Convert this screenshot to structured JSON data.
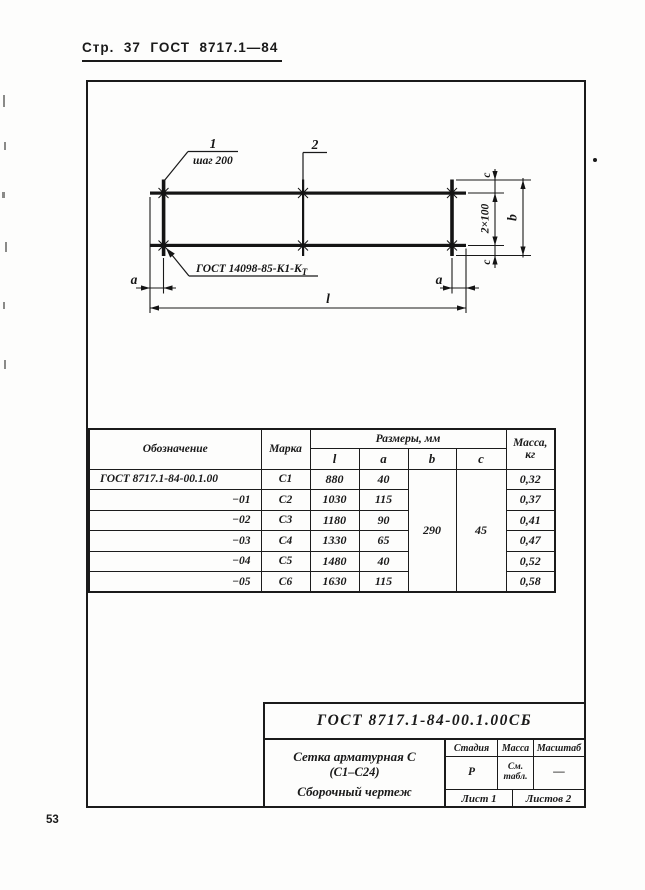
{
  "page": {
    "header": "Стр.  37  ГОСТ  8717.1—84",
    "page_number": "53"
  },
  "drawing": {
    "callout_1": "1",
    "spacing_note": "шаг 200",
    "callout_2": "2",
    "weld_note": "ГОСТ 14098-85-К1-К",
    "weld_note_sub": "Т",
    "dim_a_left": "a",
    "dim_a_right": "a",
    "dim_l": "l",
    "dim_c_top": "c",
    "dim_c_bottom": "c",
    "dim_pitch": "2×100",
    "dim_b": "b"
  },
  "table": {
    "headers": {
      "designation": "Обозначение",
      "mark": "Марка",
      "dims": "Размеры, мм",
      "l": "l",
      "a": "a",
      "b": "b",
      "c": "c",
      "mass_line1": "Масса,",
      "mass_line2": "кг"
    },
    "rows": [
      {
        "designation": "ГОСТ 8717.1-84-00.1.00",
        "mark": "С1",
        "l": "880",
        "a": "40",
        "mass": "0,32"
      },
      {
        "designation": "−01",
        "mark": "С2",
        "l": "1030",
        "a": "115",
        "mass": "0,37"
      },
      {
        "designation": "−02",
        "mark": "С3",
        "l": "1180",
        "a": "90",
        "mass": "0,41"
      },
      {
        "designation": "−03",
        "mark": "С4",
        "l": "1330",
        "a": "65",
        "mass": "0,47"
      },
      {
        "designation": "−04",
        "mark": "С5",
        "l": "1480",
        "a": "40",
        "mass": "0,52"
      },
      {
        "designation": "−05",
        "mark": "С6",
        "l": "1630",
        "a": "115",
        "mass": "0,58"
      }
    ],
    "shared": {
      "b": "290",
      "c": "45"
    }
  },
  "title_block": {
    "doc_number": "ГОСТ 8717.1-84-00.1.00СБ",
    "name_line1": "Сетка арматурная С",
    "name_line2": "(С1–С24)",
    "name_line3": "Сборочный чертеж",
    "stage_label": "Стадия",
    "mass_label": "Масса",
    "scale_label": "Масштаб",
    "stage_value": "Р",
    "mass_value_line1": "См.",
    "mass_value_line2": "табл.",
    "scale_value": "—",
    "sheet_label": "Лист 1",
    "sheets_label": "Листов 2"
  }
}
